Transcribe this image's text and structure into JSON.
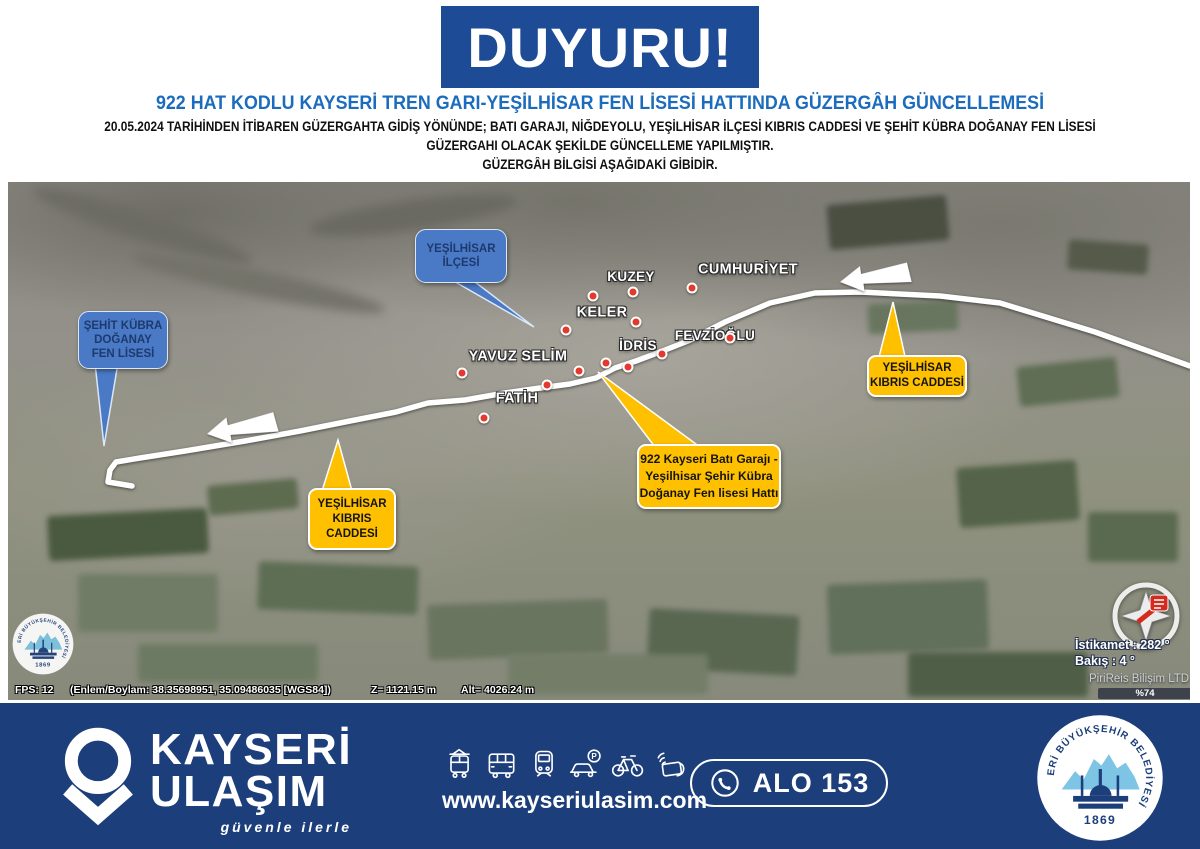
{
  "header": {
    "banner": "DUYURU!",
    "headline": "922 HAT KODLU KAYSERİ TREN GARI-YEŞİLHİSAR FEN LİSESİ HATTINDA GÜZERGÂH GÜNCELLEMESİ",
    "line1": "20.05.2024 TARİHİNDEN İTİBAREN GÜZERGAHTA GİDİŞ YÖNÜNDE; BATI GARAJI, NİĞDEYOLU, YEŞİLHİSAR İLÇESİ KIBRIS CADDESİ VE ŞEHİT KÜBRA DOĞANAY FEN LİSESİ",
    "line2": "GÜZERGAHI OLACAK ŞEKİLDE GÜNCELLEME YAPILMIŞTIR.",
    "line3": "GÜZERGÂH BİLGİSİ AŞAĞIDAKİ GİBİDİR."
  },
  "map": {
    "labels": [
      "KUZEY",
      "CUMHURİYET",
      "KELER",
      "FEVZİOĞLU",
      "İDRİS",
      "YAVUZ SELİM",
      "FATİH"
    ],
    "callouts": {
      "ilcesi": [
        "YEŞİLHİSAR",
        "İLÇESİ"
      ],
      "okul": [
        "ŞEHİT KÜBRA",
        "DOĞANAY",
        "FEN LİSESİ"
      ],
      "kibris_left": [
        "YEŞİLHİSAR",
        "KIBRIS",
        "CADDESİ"
      ],
      "hat": [
        "922 Kayseri Batı Garajı -",
        "Yeşilhisar Şehir Kübra",
        "Doğanay Fen lisesi Hattı"
      ],
      "kibris_right": [
        "YEŞİLHİSAR",
        "KIBRIS CADDESİ"
      ]
    },
    "status": {
      "fps": "FPS: 12",
      "latlon": "(Enlem/Boylam: 38.35698951, 35.09486035 [WGS84])",
      "z": "Z= 1121.15 m",
      "alt": "Alt= 4026.24 m"
    },
    "compass": {
      "heading": "İstikamet : 282 °",
      "view": "Bakış : 4 °",
      "vendor": "PiriReis Bilişim LTD",
      "percent": "%74"
    }
  },
  "footer": {
    "brand1": "KAYSERİ",
    "brand2": "ULAŞIM",
    "slogan": "güvenle ilerle",
    "website": "www.kayseriulasim.com",
    "phone": "ALO 153",
    "seal_text": "KAYSERİ BÜYÜKŞEHİR BELEDİYESİ",
    "seal_year": "1869"
  },
  "colors": {
    "banner_blue": "#1e4b96",
    "headline_blue": "#1b6cbd",
    "callout_blue": "#4a7ac6",
    "callout_yellow": "#ffc000",
    "footer_navy": "#1c3e7b",
    "route_white": "#ffffff",
    "stop_red": "#e23a2e",
    "seal_lightblue": "#7ec5e5"
  }
}
